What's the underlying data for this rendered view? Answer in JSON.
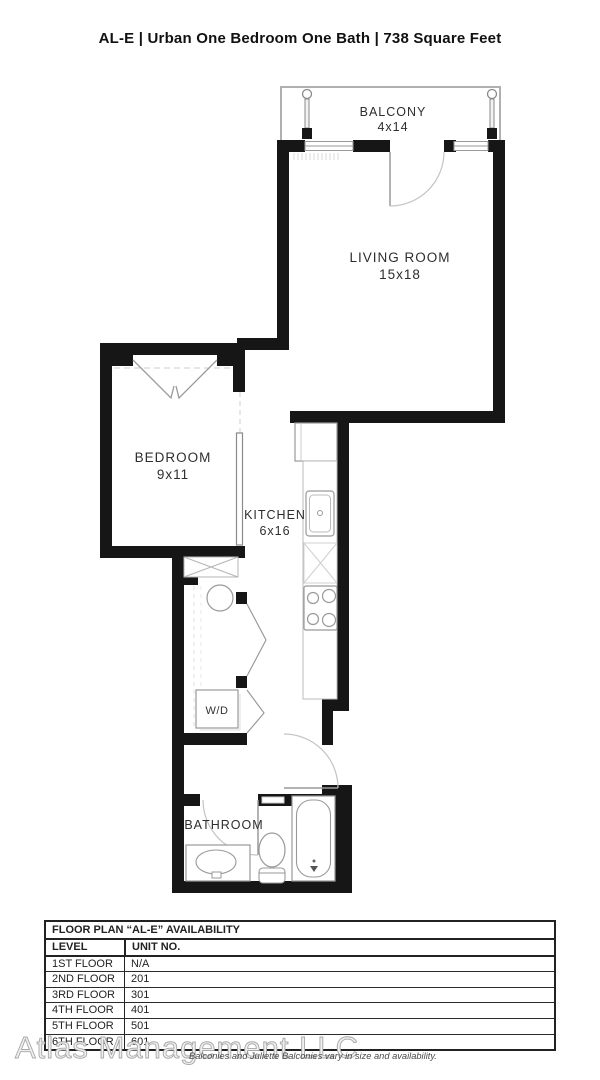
{
  "header": {
    "title": "AL-E | Urban One Bedroom One Bath | 738 Square Feet"
  },
  "floorplan": {
    "balcony": {
      "name": "BALCONY",
      "dims": "4x14"
    },
    "living_room": {
      "name": "LIVING ROOM",
      "dims": "15x18"
    },
    "bedroom": {
      "name": "BEDROOM",
      "dims": "9x11"
    },
    "kitchen": {
      "name": "KITCHEN",
      "dims": "6x16"
    },
    "laundry": {
      "label": "W/D"
    },
    "bathroom": {
      "name": "BATHROOM"
    }
  },
  "availability": {
    "title": "FLOOR PLAN “AL-E” AVAILABILITY",
    "columns": {
      "level": "LEVEL",
      "unit": "UNIT NO."
    },
    "rows": [
      {
        "level": "1ST FLOOR",
        "unit": "N/A"
      },
      {
        "level": "2ND FLOOR",
        "unit": "201"
      },
      {
        "level": "3RD FLOOR",
        "unit": "301"
      },
      {
        "level": "4TH FLOOR",
        "unit": "401"
      },
      {
        "level": "5TH FLOOR",
        "unit": "501"
      },
      {
        "level": "6TH FLOOR",
        "unit": "601"
      }
    ]
  },
  "footer": {
    "watermark": "Atlas Management LLC",
    "note": "Balconies and Juliette Balconies vary in size and availability."
  },
  "colors": {
    "wall": "#161616",
    "fixture_line": "#9a9a9a",
    "label_text": "#2e2e2e"
  }
}
